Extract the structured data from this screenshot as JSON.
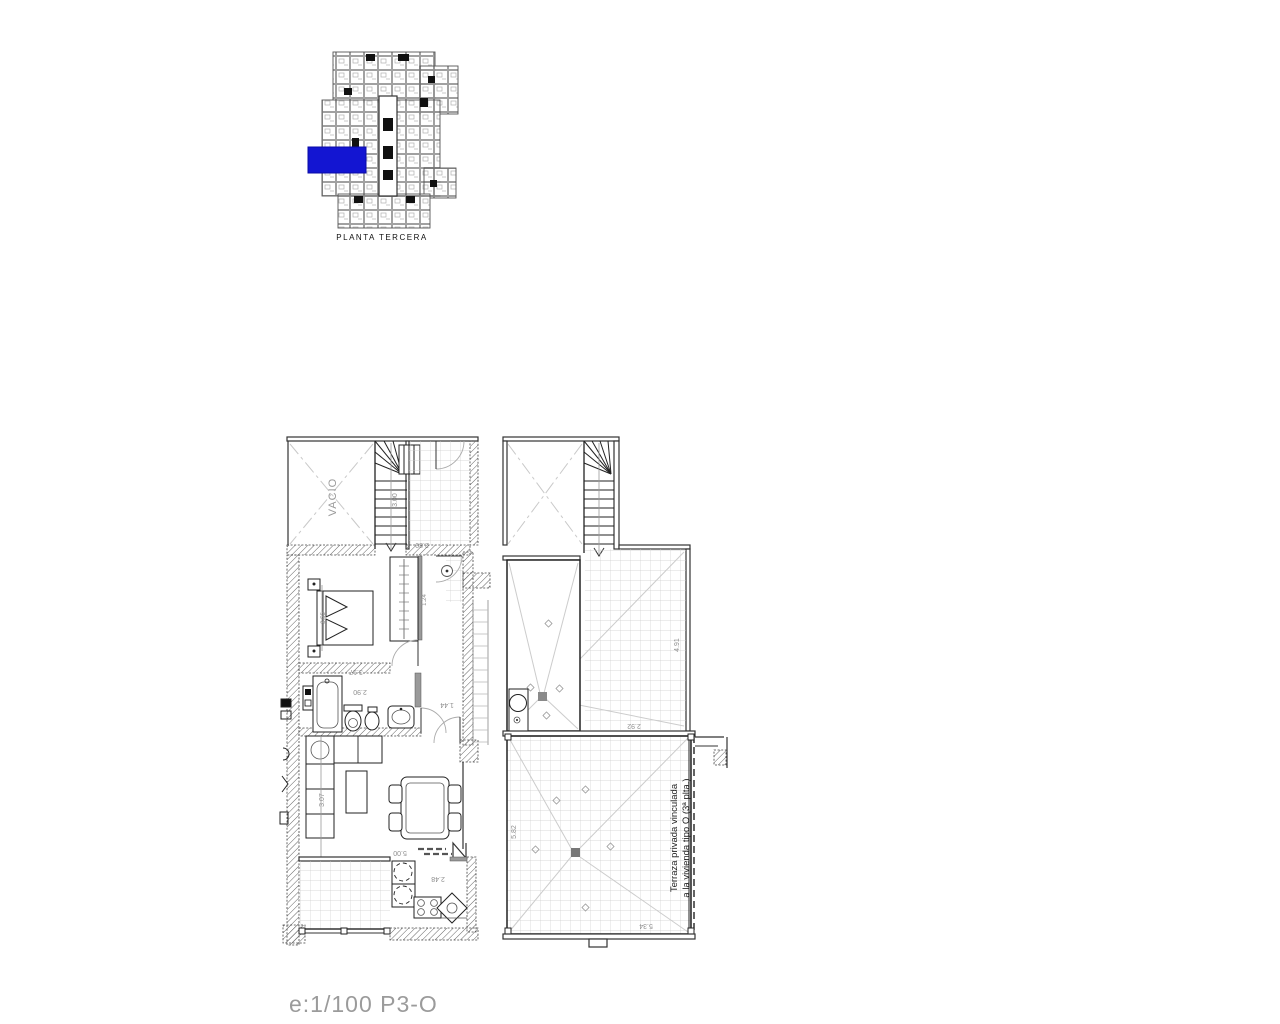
{
  "key_plan": {
    "label": "PLANTA TERCERA",
    "highlight_color": "#1315d2"
  },
  "floor_plan": {
    "vacio_label": "VACIO",
    "terrace_note": {
      "line1": "Terraza privada vinculada",
      "line2": "a la vivienda tipo O (3ª plta.)"
    },
    "dimensions": {
      "stair_flight": "3.00",
      "landing": "2.80",
      "bed_depth": "3.55",
      "bedroom_width": "3.17",
      "wardrobe": "1.24",
      "bathroom_width": "2.90",
      "hall_width": "1.44",
      "living_depth": "3.07",
      "living_width": "5.00",
      "kitchen_width": "2.48",
      "upper_terrace_depth": "4.91",
      "upper_terrace_width": "2.92",
      "main_terrace_depth": "5.82",
      "main_terrace_width": "5.34"
    }
  },
  "footer": {
    "scale_label": "e:1/100  P3-O"
  }
}
